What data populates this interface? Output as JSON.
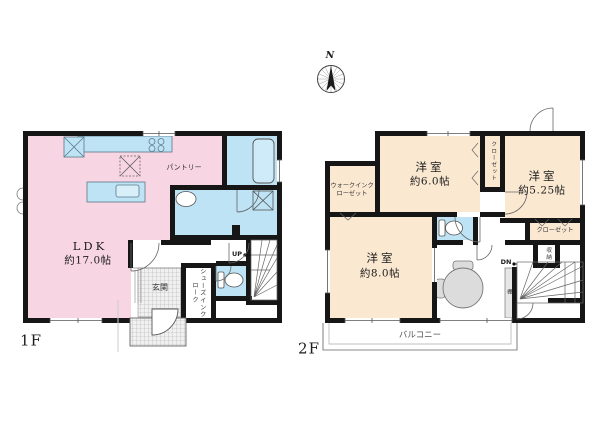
{
  "compass": {
    "north": "N"
  },
  "floor1": {
    "label": "1F",
    "ldk": {
      "name": "LDK",
      "size": "約17.0帖"
    },
    "pantry": "パントリー",
    "entrance": "玄関",
    "shoes_in_closet": "シューズインクローク",
    "stairs": "UP"
  },
  "floor2": {
    "label": "2F",
    "bedroom_north": {
      "name": "洋室",
      "size": "約6.0帖"
    },
    "bedroom_east": {
      "name": "洋室",
      "size": "約5.25帖"
    },
    "bedroom_south": {
      "name": "洋室",
      "size": "約8.0帖"
    },
    "walk_in_closet": "ウォークインクローゼット",
    "closet_north": "クローゼット",
    "closet_east": "クローゼット",
    "storage": "収納",
    "shelf": "棚",
    "balcony": "バルコニー",
    "stairs": "DN"
  },
  "colors": {
    "room_pink": "#F8D5E2",
    "room_blue": "#BDE3F5",
    "room_cream": "#FAE8D1",
    "wall": "#161616"
  }
}
